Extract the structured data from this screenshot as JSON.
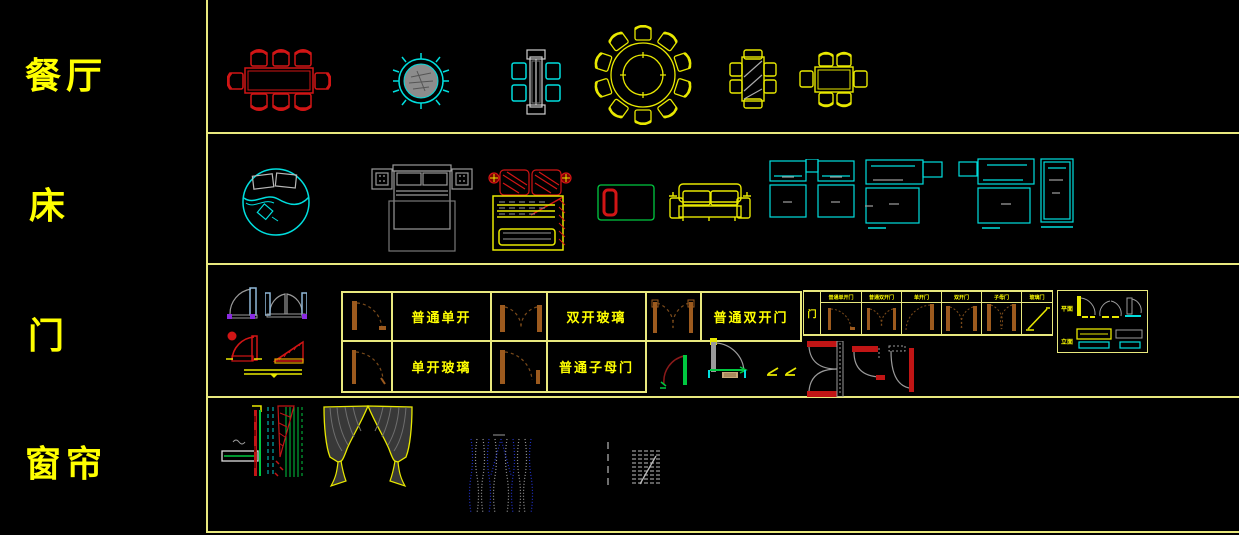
{
  "window": {
    "width": 1239,
    "height": 535,
    "background": "#000000"
  },
  "palette": {
    "grid_line": "#E9E97E",
    "label_yellow": "#FFFF00",
    "block_yellow": "#E8E800",
    "block_red": "#D11515",
    "block_cyan": "#00DEDE",
    "block_green": "#00C840",
    "block_gray": "#9A9A9A",
    "block_brown": "#9C5A1E",
    "block_blue": "#2233CC",
    "block_lightblue": "#8FB8D8",
    "block_purple": "#8A2BE2"
  },
  "sidebar": {
    "categories": [
      {
        "id": "dining",
        "label": "餐厅"
      },
      {
        "id": "bed",
        "label": "床"
      },
      {
        "id": "door",
        "label": "门"
      },
      {
        "id": "curtain",
        "label": "窗帘"
      }
    ]
  },
  "door_tables": {
    "main": {
      "cells": [
        {
          "label": "普通单开"
        },
        {
          "label": "双开玻璃"
        },
        {
          "label": "普通双开门"
        },
        {
          "label": "单开玻璃"
        },
        {
          "label": "普通子母门"
        }
      ]
    },
    "types": {
      "side_label": "门",
      "headers": [
        {
          "label": "普通单开门"
        },
        {
          "label": "普通双开门"
        },
        {
          "label": "单开门"
        },
        {
          "label": "双开门"
        },
        {
          "label": "子母门"
        },
        {
          "label": "玻璃门"
        }
      ]
    },
    "legend": {
      "rows": [
        {
          "label": "平面"
        },
        {
          "label": "立面"
        }
      ]
    }
  }
}
